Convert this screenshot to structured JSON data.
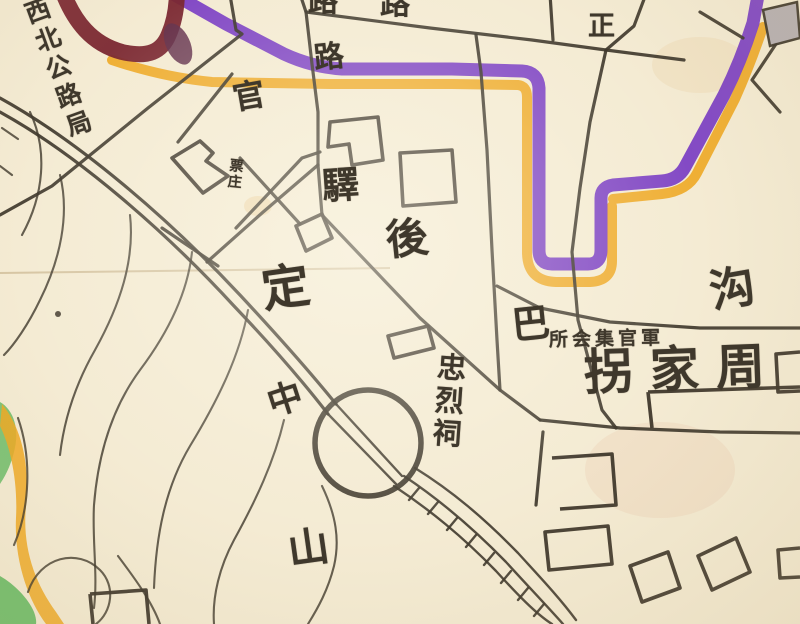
{
  "colors": {
    "paper": "#f4ebd3",
    "ink": "#3f382c",
    "wall_purple": "#7e43c4",
    "wall_orange": "#eea923",
    "river_maroon": "#7a2831",
    "terrain_green": "#72bf6d",
    "terrain_orange": "#eea923",
    "building_gray": "#b5aeb2"
  },
  "labels": {
    "nw_highway_bureau": "西北公路局",
    "guan": "官",
    "station": "驛",
    "hou": "後",
    "zheng": "正",
    "lu_top_partial_1": "路",
    "lu_top_partial_2": "路",
    "lu": "路",
    "piao_zhuang": "票庄",
    "ding": "定",
    "zhong": "中",
    "shan": "山",
    "ba": "巴",
    "gou": "沟",
    "martyrs_shrine": "忠烈祠",
    "officers_club": "所会集官軍",
    "zhou_jia_guai": "拐家周"
  }
}
